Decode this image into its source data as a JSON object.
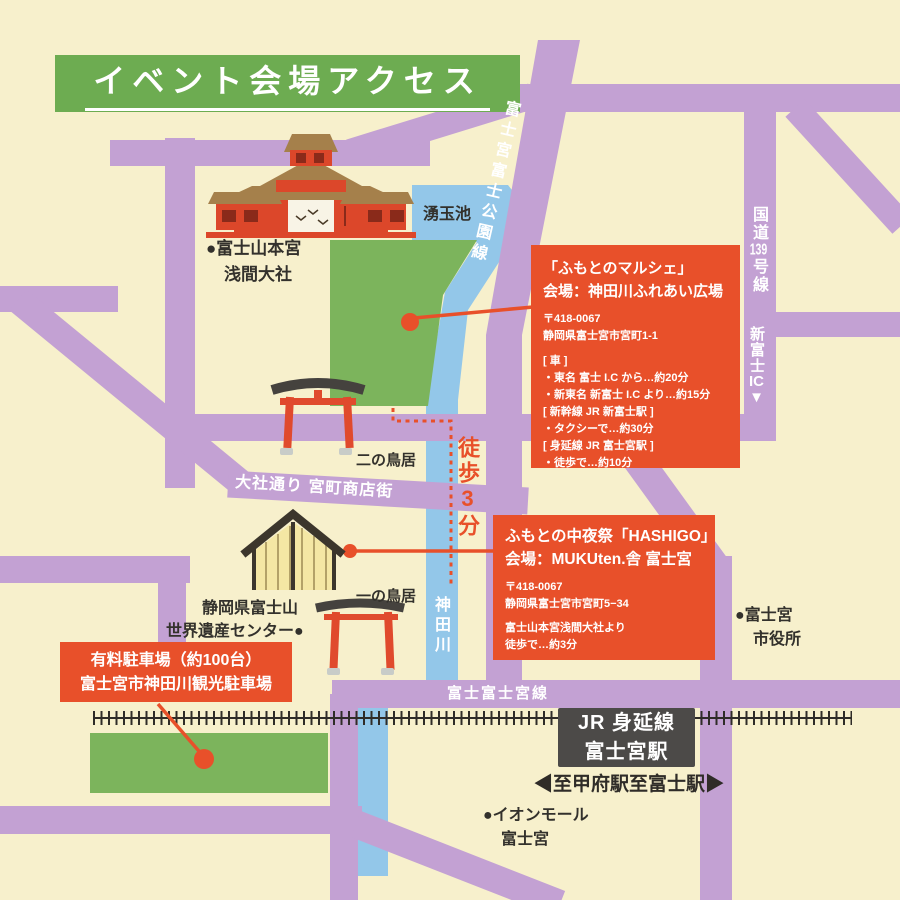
{
  "title": "イベント会場アクセス",
  "colors": {
    "background": "#f7f0cc",
    "road_purple": "#c3a1d3",
    "water_blue": "#93c7e9",
    "park_green": "#7cb45c",
    "banner_green": "#6dac51",
    "accent_orange": "#e8502a",
    "station_gray": "#4c4a48",
    "text_dark": "#33312c"
  },
  "labels": {
    "pond": "湧玉池",
    "sengen_l1": "●富士山本宮",
    "sengen_l2": "浅間大社",
    "road_parkline": "富士宮富士公園線",
    "road139_part1": "国道",
    "road139_part2": "139",
    "road139_part3": "号線",
    "ic_name": "新富士",
    "ic_suffix": "IC",
    "ic_arrow": "▼",
    "nino_torii": "二の鳥居",
    "walk_route": "徒歩3分",
    "road_taisha": "大社通り 宮町商店街",
    "ichino_torii": "一の鳥居",
    "river": "神田川",
    "heritage_l1": "静岡県富士山",
    "heritage_l2": "世界遺産センター●",
    "cityhall_l1": "●富士宮",
    "cityhall_l2": "市役所",
    "road_fujifujinomiya": "富士富士宮線",
    "aeon_l1": "●イオンモール",
    "aeon_l2": "富士宮"
  },
  "venues": {
    "marche": {
      "title_l1": "「ふもとのマルシェ」",
      "title_l2": "会場：神田川ふれあい広場",
      "postal": "〒418-0067",
      "address": "静岡県富士宮市宮町1-1",
      "access": [
        "[ 車 ]",
        "・東名 富士 I.C から…約20分",
        "・新東名 新富士 I.C より…約15分",
        "[ 新幹線 JR 新富士駅 ]",
        "・タクシーで…約30分",
        "[ 身延線 JR 富士宮駅 ]",
        "・徒歩で…約10分"
      ]
    },
    "hashigo": {
      "title_l1": "ふもとの中夜祭「HASHIGO」",
      "title_l2": "会場：MUKUten.舎 富士宮",
      "postal": "〒418-0067",
      "address": "静岡県富士宮市宮町5−34",
      "note_l1": "富士山本宮浅間大社より",
      "note_l2": "徒歩で…約3分"
    },
    "parking": {
      "line1": "有料駐車場（約100台）",
      "line2": "富士宮市神田川観光駐車場"
    }
  },
  "station": {
    "line1": "JR 身延線",
    "line2": "富士宮駅",
    "direction_left": "◀至甲府駅",
    "direction_right": "至富士駅▶"
  }
}
